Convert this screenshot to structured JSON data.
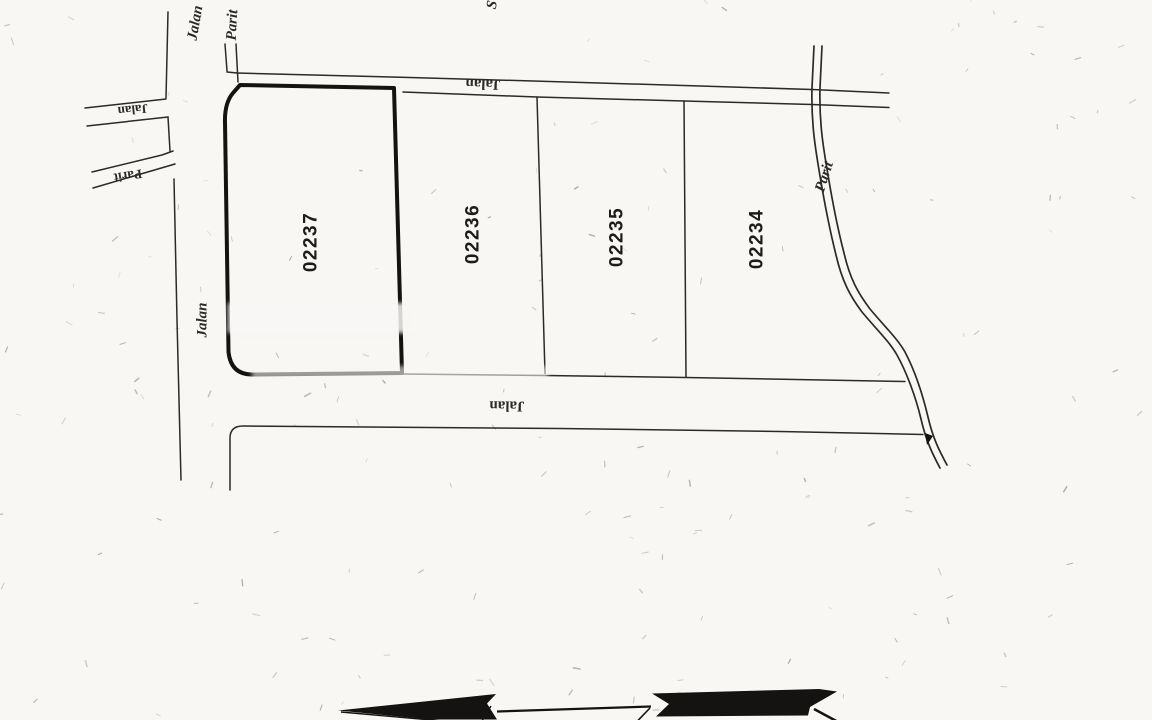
{
  "lots": [
    {
      "number": "02237"
    },
    {
      "number": "02236"
    },
    {
      "number": "02235"
    },
    {
      "number": "02234"
    }
  ],
  "labels": {
    "jalan_top": "Jalan",
    "jalan_bottom": "Jalan",
    "jalan_left_branch": "Jalan",
    "jalan_left_vertical": "Jalan",
    "jalan_top_left": "Jalan",
    "parit_top_left": "Parit",
    "parit_left_branch": "Parit",
    "parit_right": "Parit",
    "top_edge_partial_text": "S"
  },
  "colors": {
    "paper": "#f8f7f4",
    "ink": "#2b2a28",
    "thick_ink": "#141312",
    "speckle": "#6b675f"
  }
}
